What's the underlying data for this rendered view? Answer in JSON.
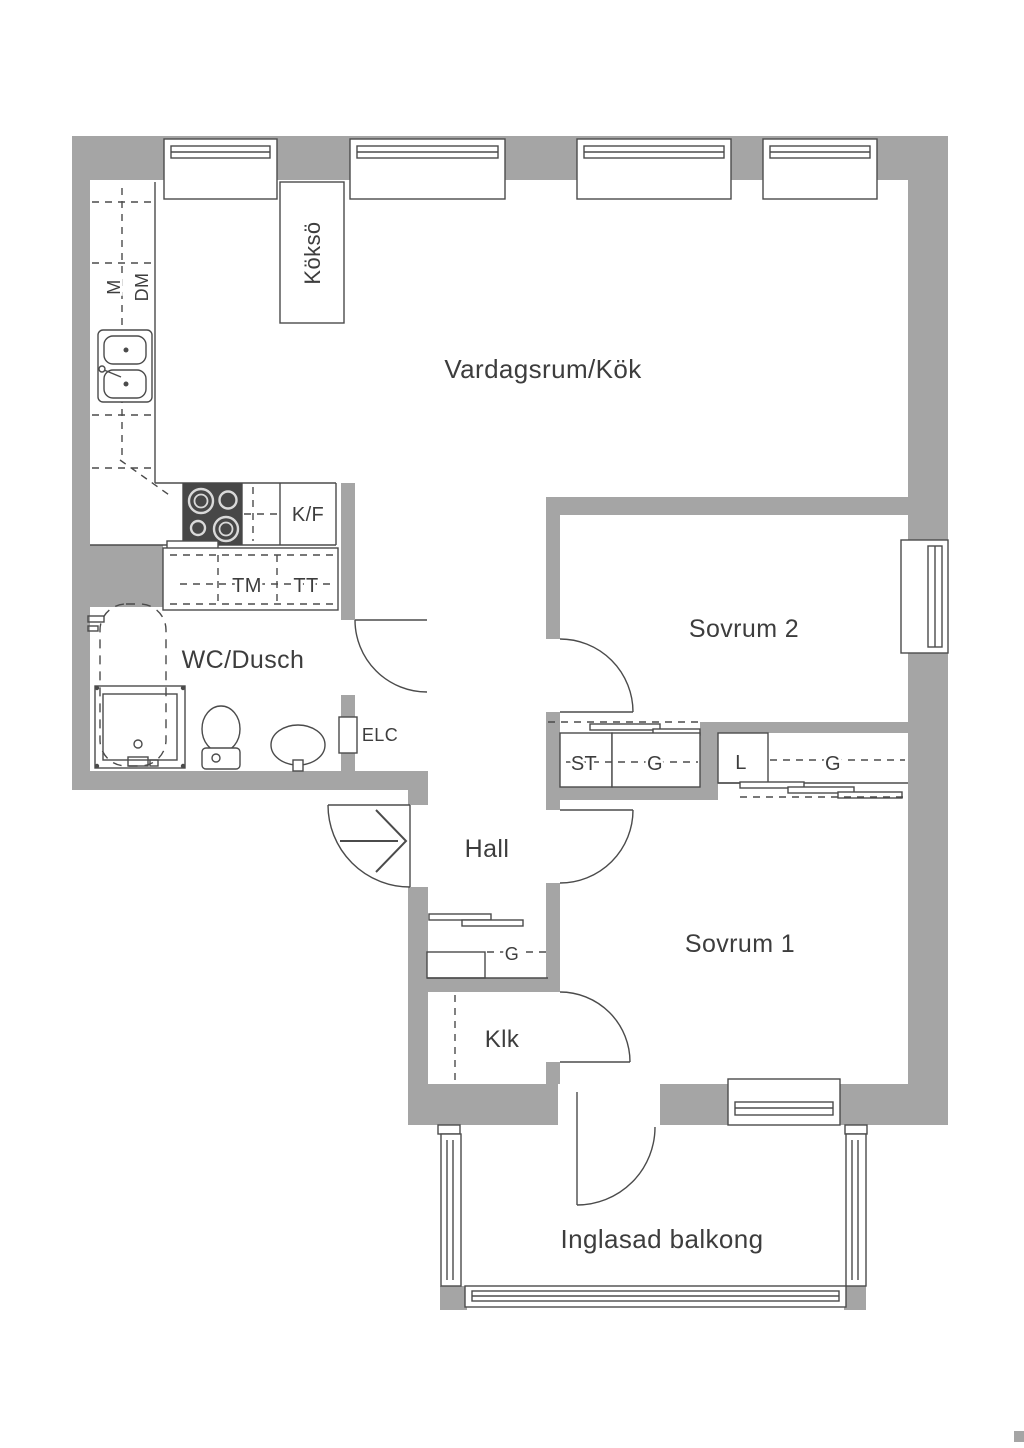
{
  "plan": {
    "rooms": {
      "living": "Vardagsrum/Kök",
      "bedroom2": "Sovrum 2",
      "bedroom1": "Sovrum 1",
      "bathroom": "WC/Dusch",
      "hall": "Hall",
      "walk_in_closet": "Klk",
      "balcony": "Inglasad balkong"
    },
    "kitchen": {
      "island": "Köksö",
      "microwave": "M",
      "dishwasher": "DM",
      "fridge_freezer": "K/F"
    },
    "laundry": {
      "washing_machine": "TM",
      "tumble_dryer": "TT"
    },
    "utility": {
      "electrical_cabinet": "ELC"
    },
    "storage": {
      "cleaning_closet": "ST",
      "wardrobe_bedroom2": "G",
      "linen_closet": "L",
      "wardrobe_bedroom1": "G",
      "wardrobe_hall": "G"
    },
    "colors": {
      "wall_gray": "#a5a5a5",
      "line_dark": "#4b4b4b",
      "text_dark": "#3d3d3d",
      "stove_dark": "#474747",
      "background": "#ffffff"
    }
  }
}
